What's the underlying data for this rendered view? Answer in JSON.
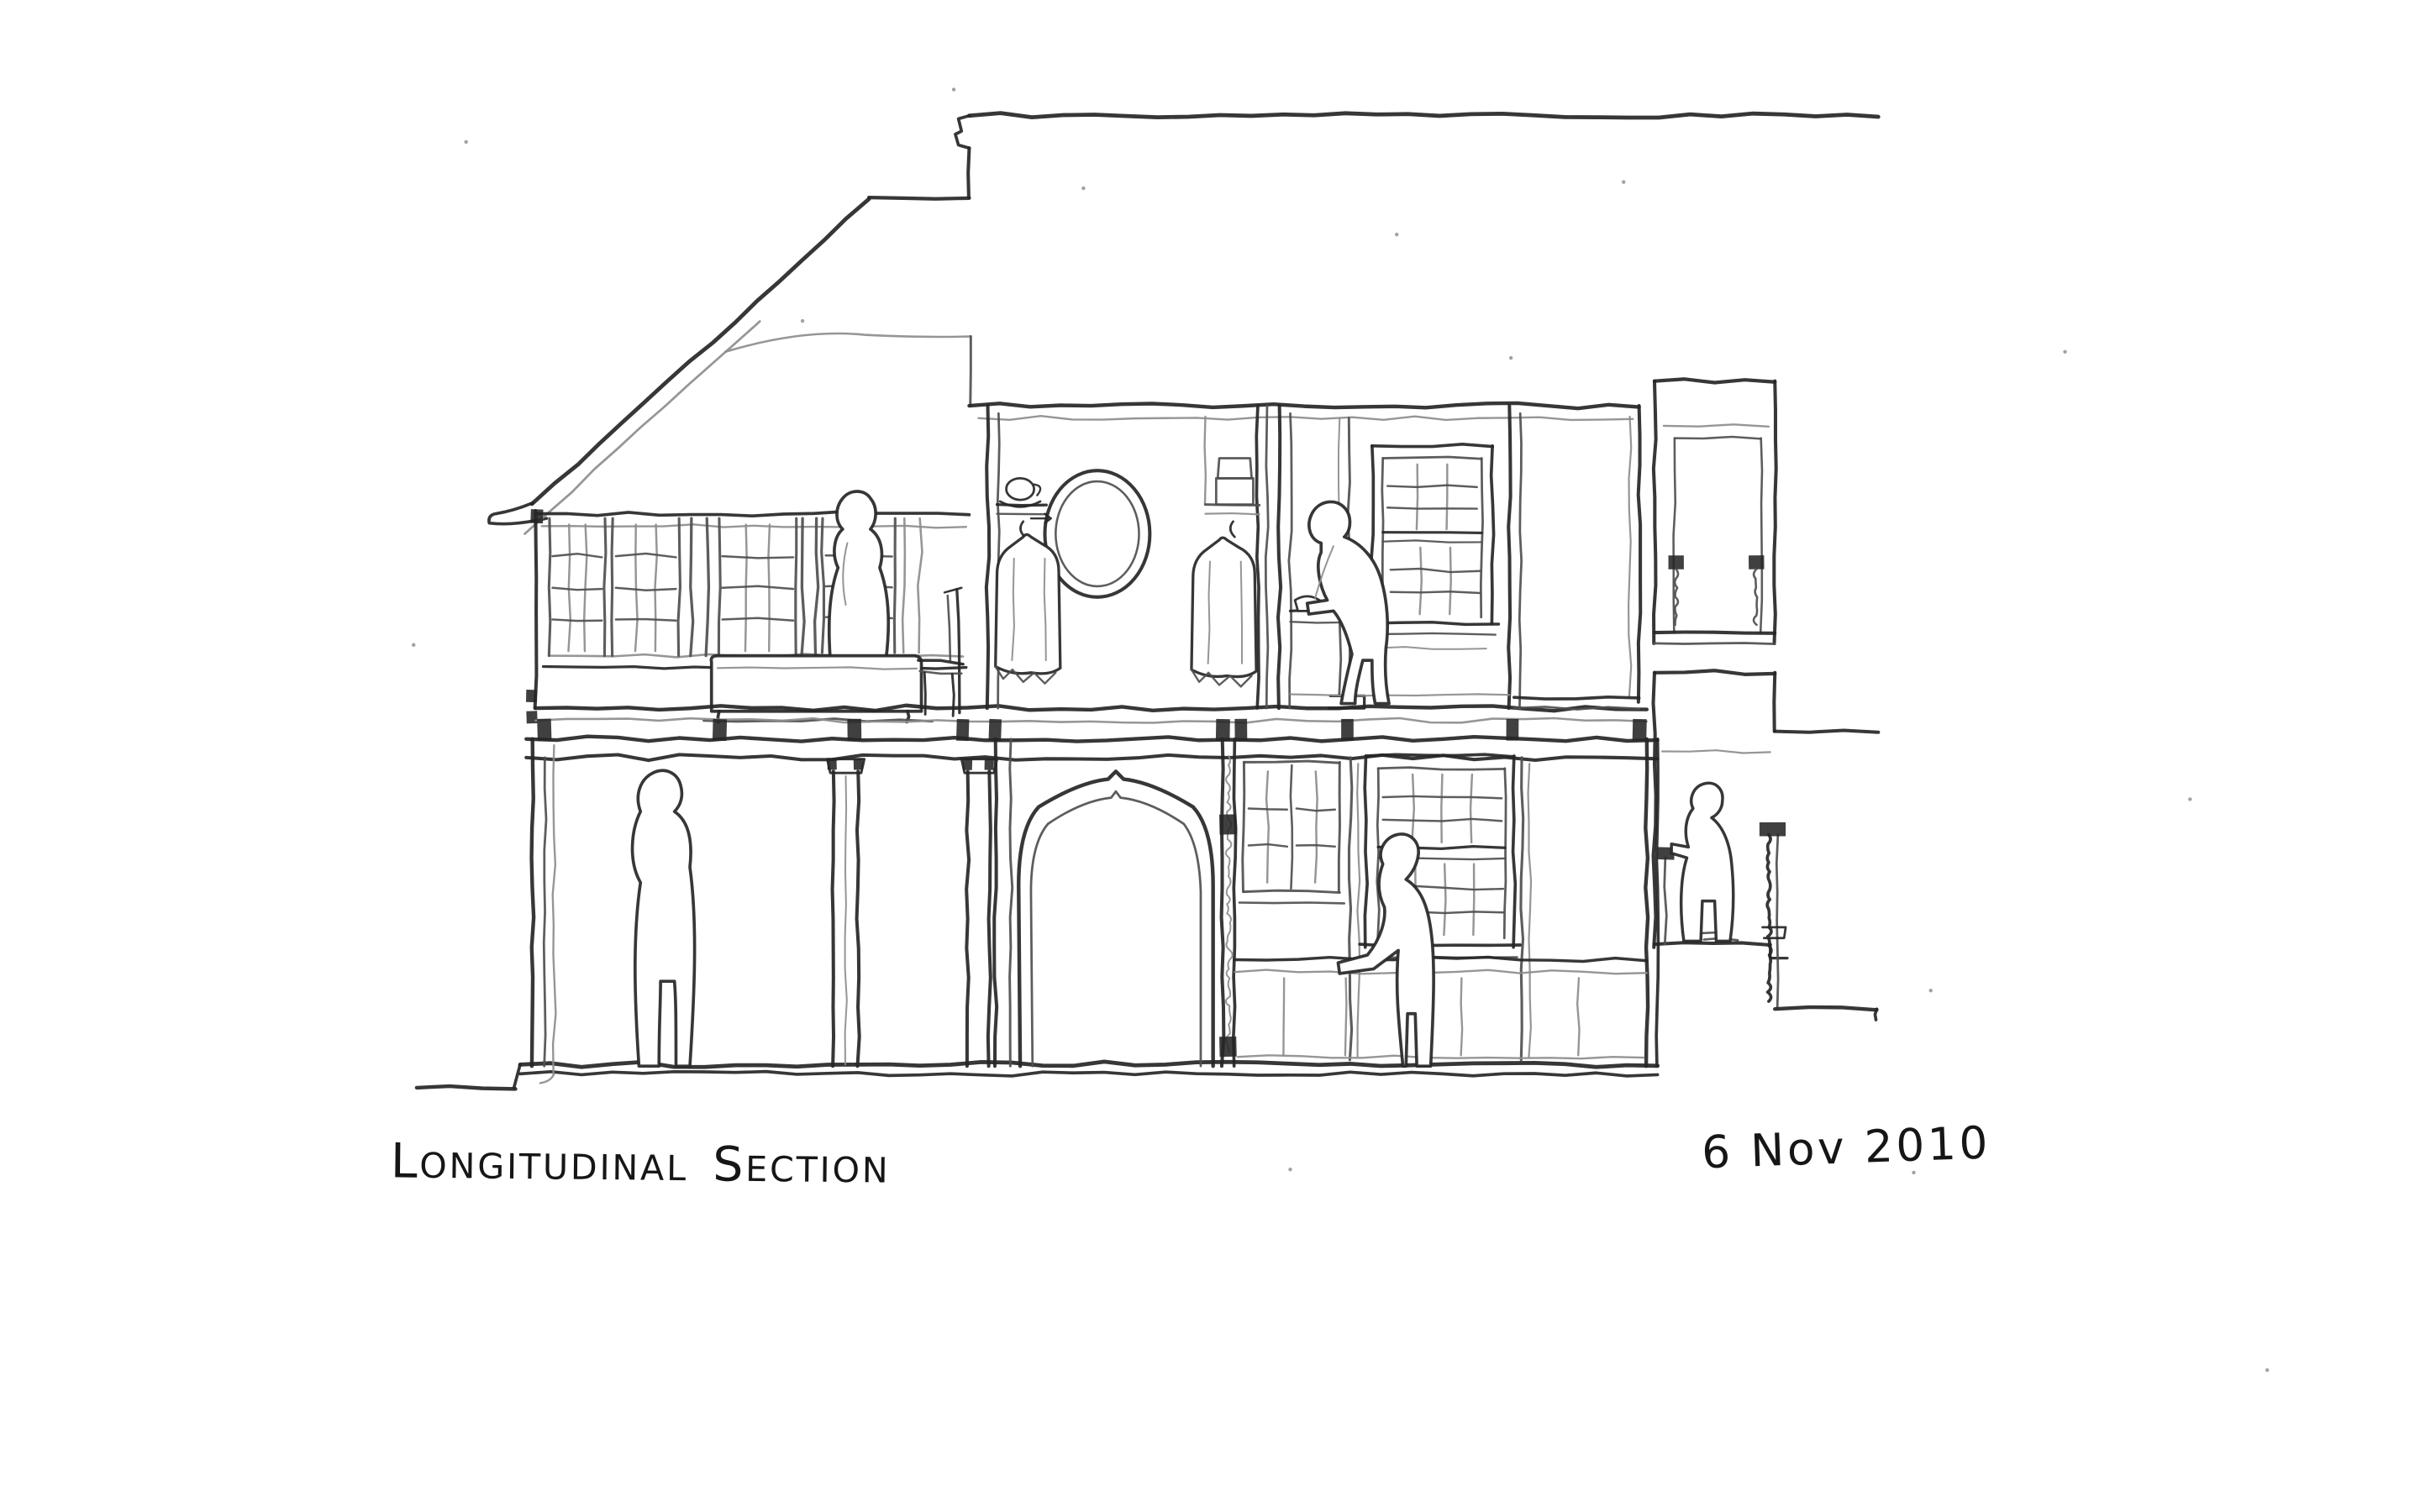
{
  "captions": {
    "title": "Longitudinal Section",
    "date": "6 Nov 2010"
  },
  "palette": {
    "paper": "#ffffff",
    "ink_dark": "#262626",
    "ink_mid": "#4f4f4f",
    "ink_light": "#8d8d8d"
  }
}
